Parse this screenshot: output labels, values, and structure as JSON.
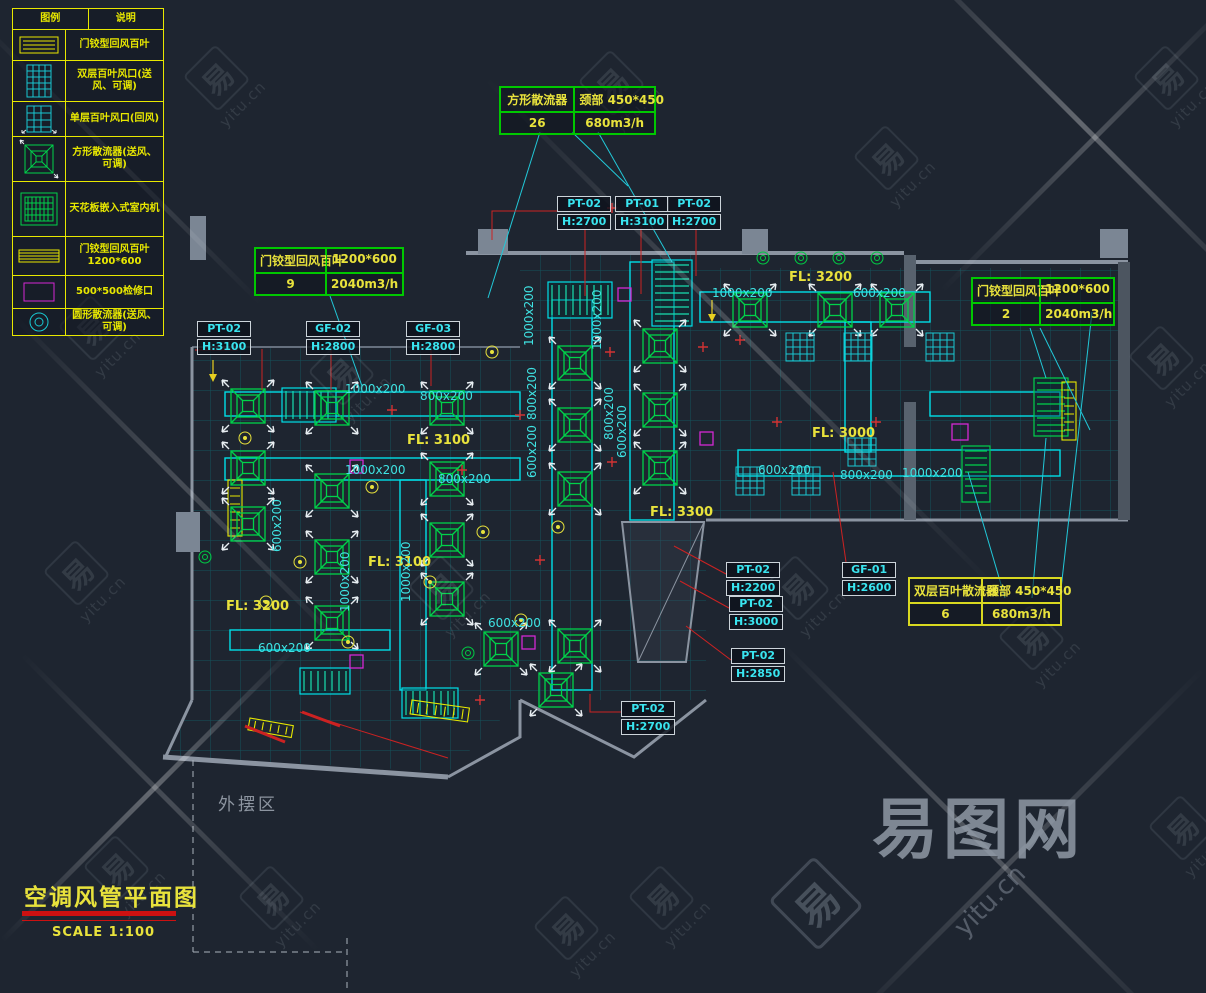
{
  "title_block": {
    "title": "空调风管平面图",
    "scale": "SCALE 1:100"
  },
  "area_label": "外摆区",
  "watermark": {
    "brand": "易图网",
    "domain": "yitu.cn",
    "glyph": "易"
  },
  "colors": {
    "background": "#1e2530",
    "duct_cyan": "#00dfe8",
    "diffuser_green": "#00d24a",
    "annotation_yellow": "#e8e23c",
    "leader_red": "#cc1111",
    "access_magenta": "#d428d4",
    "wall_gray": "#8b94a1"
  },
  "legend": {
    "headers": [
      "图例",
      "说明"
    ],
    "rows": [
      {
        "symbol": "return-louver-icon",
        "label": "门铰型回风百叶"
      },
      {
        "symbol": "double-grille-icon",
        "label": "双层百叶风口(送风、可调)"
      },
      {
        "symbol": "single-grille-icon",
        "label": "单层百叶风口(回风)"
      },
      {
        "symbol": "square-diffuser-icon",
        "label": "方形散流器(送风、可调)"
      },
      {
        "symbol": "cassette-unit-icon",
        "label": "天花板嵌入式室内机"
      },
      {
        "symbol": "louver-1200-icon",
        "label": "门铰型回风百叶1200*600"
      },
      {
        "symbol": "access-panel-icon",
        "label": "500*500检修口"
      },
      {
        "symbol": "round-diffuser-icon",
        "label": "圆形散流器(送风、可调)"
      }
    ]
  },
  "info_boxes": [
    {
      "name": "方形散流器",
      "spec": "颈部 450*450",
      "count": "26",
      "flow": "680m3/h",
      "x": 499,
      "y": 86,
      "w": 155,
      "border": "#00c800"
    },
    {
      "name": "门铰型回风百叶",
      "spec": "1200*600",
      "count": "9",
      "flow": "2040m3/h",
      "x": 254,
      "y": 247,
      "w": 148,
      "border": "#00c800"
    },
    {
      "name": "门铰型回风百叶",
      "spec": "1200*600",
      "count": "2",
      "flow": "2040m3/h",
      "x": 971,
      "y": 277,
      "w": 142,
      "border": "#00c800"
    },
    {
      "name": "双层百叶散流器",
      "spec": "颈部 450*450",
      "count": "6",
      "flow": "680m3/h",
      "x": 908,
      "y": 577,
      "w": 152,
      "border": "#d8d820"
    }
  ],
  "equipment_tags": [
    {
      "code": "PT-02",
      "height": "H:2700",
      "x": 557,
      "y": 196
    },
    {
      "code": "PT-01",
      "height": "H:3100",
      "x": 615,
      "y": 196
    },
    {
      "code": "PT-02",
      "height": "H:2700",
      "x": 667,
      "y": 196
    },
    {
      "code": "PT-02",
      "height": "H:3100",
      "x": 197,
      "y": 321
    },
    {
      "code": "GF-02",
      "height": "H:2800",
      "x": 306,
      "y": 321
    },
    {
      "code": "GF-03",
      "height": "H:2800",
      "x": 406,
      "y": 321
    },
    {
      "code": "PT-02",
      "height": "H:2200",
      "x": 726,
      "y": 562
    },
    {
      "code": "GF-01",
      "height": "H:2600",
      "x": 842,
      "y": 562
    },
    {
      "code": "PT-02",
      "height": "H:3000",
      "x": 729,
      "y": 596
    },
    {
      "code": "PT-02",
      "height": "H:2850",
      "x": 731,
      "y": 648
    },
    {
      "code": "PT-02",
      "height": "H:2700",
      "x": 621,
      "y": 701
    }
  ],
  "fl_labels": [
    {
      "text": "FL: 3200",
      "x": 789,
      "y": 270
    },
    {
      "text": "FL: 3100",
      "x": 407,
      "y": 433
    },
    {
      "text": "FL: 3000",
      "x": 812,
      "y": 426
    },
    {
      "text": "FL: 3300",
      "x": 650,
      "y": 505
    },
    {
      "text": "FL: 3100",
      "x": 368,
      "y": 555
    },
    {
      "text": "FL: 3200",
      "x": 226,
      "y": 599
    }
  ],
  "duct_dims": [
    {
      "text": "1000x200",
      "x": 712,
      "y": 286
    },
    {
      "text": "600x200",
      "x": 853,
      "y": 286
    },
    {
      "text": "1000x200",
      "x": 345,
      "y": 382
    },
    {
      "text": "800x200",
      "x": 420,
      "y": 389
    },
    {
      "text": "1000x200",
      "x": 345,
      "y": 463
    },
    {
      "text": "800x200",
      "x": 438,
      "y": 472
    },
    {
      "text": "600x200",
      "x": 758,
      "y": 463
    },
    {
      "text": "800x200",
      "x": 840,
      "y": 468
    },
    {
      "text": "1000x200",
      "x": 902,
      "y": 466
    },
    {
      "text": "600x200",
      "x": 488,
      "y": 616
    },
    {
      "text": "600x200",
      "x": 258,
      "y": 641
    },
    {
      "text": "1000x200",
      "x": 536,
      "y": 332,
      "vertical": true
    },
    {
      "text": "800x200",
      "x": 539,
      "y": 406,
      "vertical": true
    },
    {
      "text": "600x200",
      "x": 539,
      "y": 464,
      "vertical": true
    },
    {
      "text": "1000x200",
      "x": 604,
      "y": 336,
      "vertical": true
    },
    {
      "text": "800x200",
      "x": 616,
      "y": 426,
      "vertical": true
    },
    {
      "text": "600x200",
      "x": 629,
      "y": 444,
      "vertical": true
    },
    {
      "text": "1000x200",
      "x": 413,
      "y": 588,
      "vertical": true
    },
    {
      "text": "1000x200",
      "x": 352,
      "y": 598,
      "vertical": true
    },
    {
      "text": "600x200",
      "x": 284,
      "y": 538,
      "vertical": true
    }
  ],
  "watermark_tiles": [
    {
      "x": 195,
      "y": 50
    },
    {
      "x": 590,
      "y": 55
    },
    {
      "x": 865,
      "y": 130
    },
    {
      "x": 1145,
      "y": 50
    },
    {
      "x": 70,
      "y": 300
    },
    {
      "x": 320,
      "y": 345
    },
    {
      "x": 55,
      "y": 545
    },
    {
      "x": 1140,
      "y": 330
    },
    {
      "x": 95,
      "y": 840
    },
    {
      "x": 545,
      "y": 900
    },
    {
      "x": 775,
      "y": 560
    },
    {
      "x": 1010,
      "y": 610
    },
    {
      "x": 640,
      "y": 870
    },
    {
      "x": 420,
      "y": 560
    },
    {
      "x": 1160,
      "y": 800
    },
    {
      "x": 250,
      "y": 870
    }
  ]
}
